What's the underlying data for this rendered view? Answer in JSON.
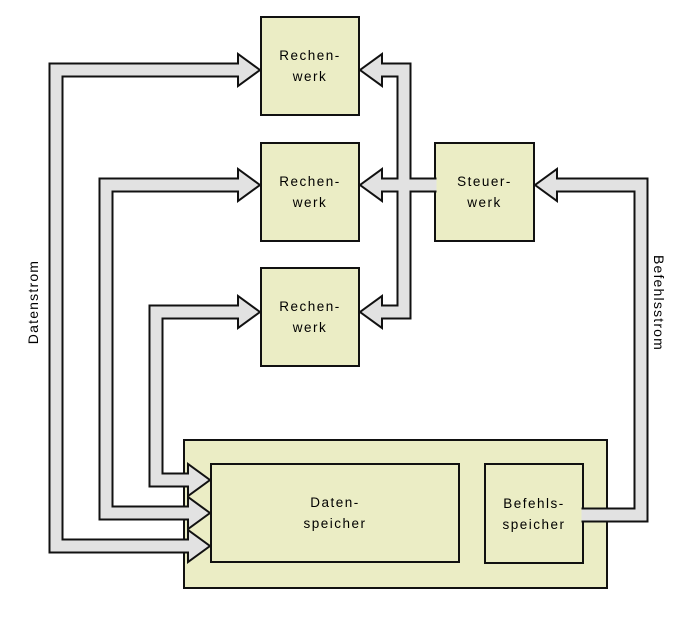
{
  "diagram": {
    "type": "architecture-block-diagram",
    "colors": {
      "background": "#ffffff",
      "box_fill": "#ebedc5",
      "box_border": "#111111",
      "flow_fill": "#e2e2e2",
      "flow_border": "#111111",
      "text": "#000000"
    },
    "nodes": [
      {
        "id": "rechenwerk-1",
        "line1": "Rechen-",
        "line2": "werk"
      },
      {
        "id": "rechenwerk-2",
        "line1": "Rechen-",
        "line2": "werk"
      },
      {
        "id": "rechenwerk-3",
        "line1": "Rechen-",
        "line2": "werk"
      },
      {
        "id": "steuerwerk",
        "line1": "Steuer-",
        "line2": "werk"
      },
      {
        "id": "datenspeicher",
        "line1": "Daten-",
        "line2": "speicher"
      },
      {
        "id": "befehlsspeicher",
        "line1": "Befehls-",
        "line2": "speicher"
      }
    ],
    "streams": {
      "data": "Datenstrom",
      "instruction": "Befehlsstrom"
    },
    "connections": [
      {
        "from": "datenspeicher",
        "to": "rechenwerk-1",
        "type": "bidirectional",
        "stream": "Datenstrom"
      },
      {
        "from": "datenspeicher",
        "to": "rechenwerk-2",
        "type": "bidirectional",
        "stream": "Datenstrom"
      },
      {
        "from": "datenspeicher",
        "to": "rechenwerk-3",
        "type": "bidirectional",
        "stream": "Datenstrom"
      },
      {
        "from": "steuerwerk",
        "to": "rechenwerk-1",
        "type": "directed"
      },
      {
        "from": "steuerwerk",
        "to": "rechenwerk-2",
        "type": "directed"
      },
      {
        "from": "steuerwerk",
        "to": "rechenwerk-3",
        "type": "directed"
      },
      {
        "from": "befehlsspeicher",
        "to": "steuerwerk",
        "type": "directed",
        "stream": "Befehlsstrom"
      }
    ]
  }
}
